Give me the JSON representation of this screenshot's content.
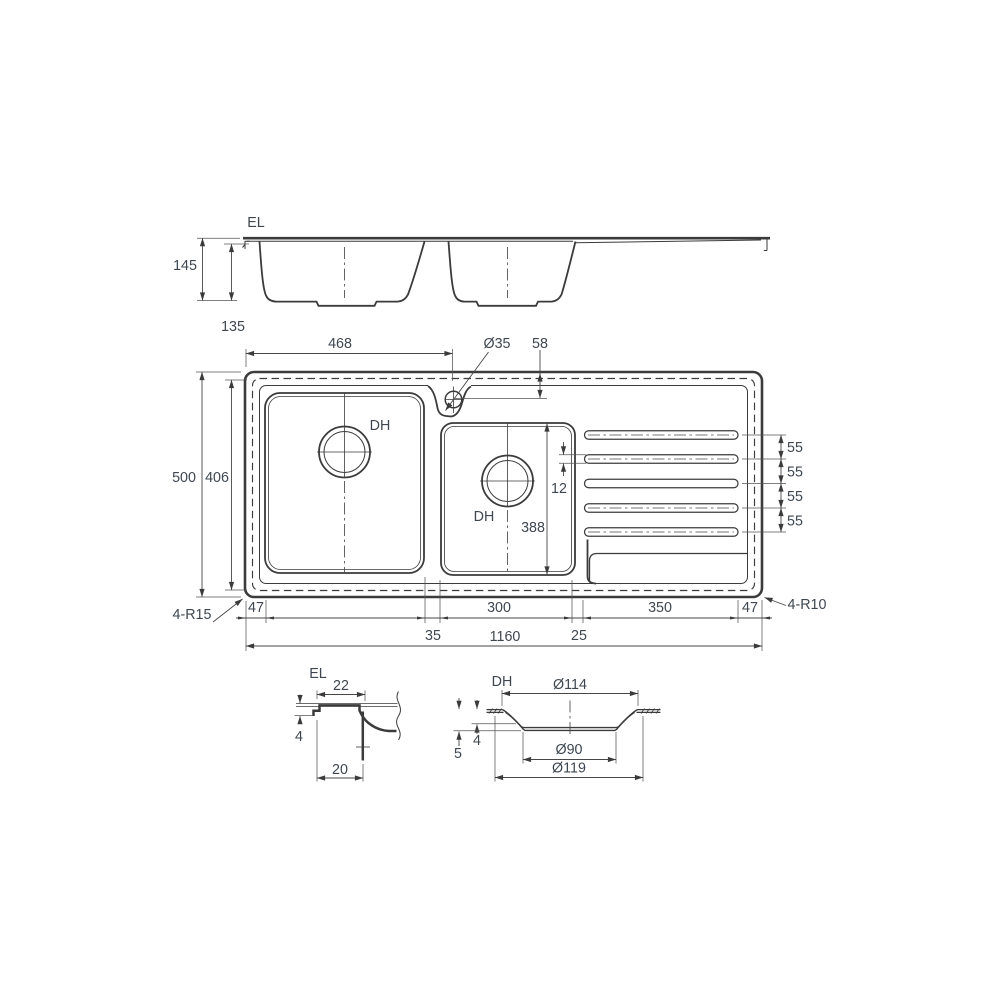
{
  "colors": {
    "line": "#3b3b3b",
    "dim_text": "#3e4750",
    "background": "#ffffff"
  },
  "elevation": {
    "edge_lip_label": "EL",
    "overall_depth": "145",
    "bowl_depth": "135"
  },
  "plan": {
    "left_section_width": "468",
    "tap_hole_diameter": "Ø35",
    "tap_hole_offset": "58",
    "overall_depth": "500",
    "inner_depth": "406",
    "drain_left_label": "DH",
    "drain_right_label": "DH",
    "groove_width": "12",
    "right_bowl_depth": "388",
    "groove_pitch_1": "55",
    "groove_pitch_2": "55",
    "groove_pitch_3": "55",
    "groove_pitch_4": "55",
    "corner_radius_left": "4-R15",
    "corner_radius_right": "4-R10",
    "edge_left": "47",
    "divider": "35",
    "right_bowl_width": "300",
    "drainer_gap": "25",
    "drainer_length": "350",
    "edge_right": "47",
    "overall_length": "1160"
  },
  "edge_lip_detail": {
    "label": "EL",
    "lip_top_width": "22",
    "lip_height": "4",
    "lip_base_width": "20"
  },
  "drain_hole_detail": {
    "label": "DH",
    "top_diameter": "Ø114",
    "seat_depth": "4",
    "total_depth": "5",
    "inner_diameter": "Ø90",
    "flange_diameter": "Ø119"
  }
}
